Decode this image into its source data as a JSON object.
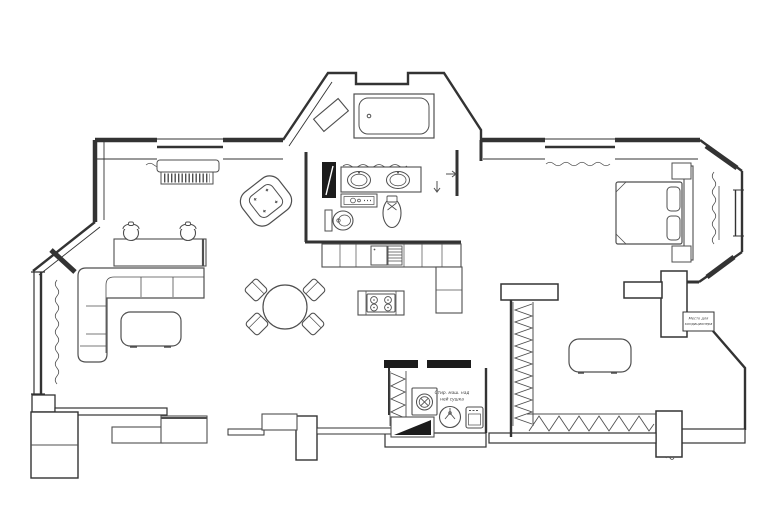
{
  "document": {
    "kind": "apartment floor plan drawing"
  },
  "colors": {
    "background": "#ffffff",
    "wall": "#333333",
    "furniture": "#4f4f4f",
    "door_leaf": "#1c1c1c"
  },
  "annotations": {
    "ac_note": {
      "line1": "Место для",
      "line2": "кондиционера"
    },
    "laundry_note": {
      "line1": "Стир. маш. над",
      "line2": "ней сушка"
    }
  },
  "fixtures": [
    "bathtub",
    "corner-shelf",
    "double-sink-vanity",
    "cosmetics-shelf",
    "toilet",
    "bidet",
    "bathroom-door-leaf",
    "kitchen-counter",
    "refrigerator",
    "dishwasher",
    "kitchen-island",
    "hob-4-burners",
    "dining-table",
    "dining-chair",
    "corner-sofa",
    "coffee-table",
    "desk",
    "desk-chair",
    "armchair",
    "window-sill-shelf",
    "radiator",
    "curtains",
    "bed",
    "pillow",
    "headboard",
    "nightstand",
    "wardrobe-rail",
    "ottoman",
    "ac-niche",
    "washing-machine",
    "laundry-sink",
    "water-heater",
    "drying-rack",
    "entry-door-leaf",
    "entry-closet",
    "shoe-cabinet",
    "console",
    "hall-column"
  ]
}
